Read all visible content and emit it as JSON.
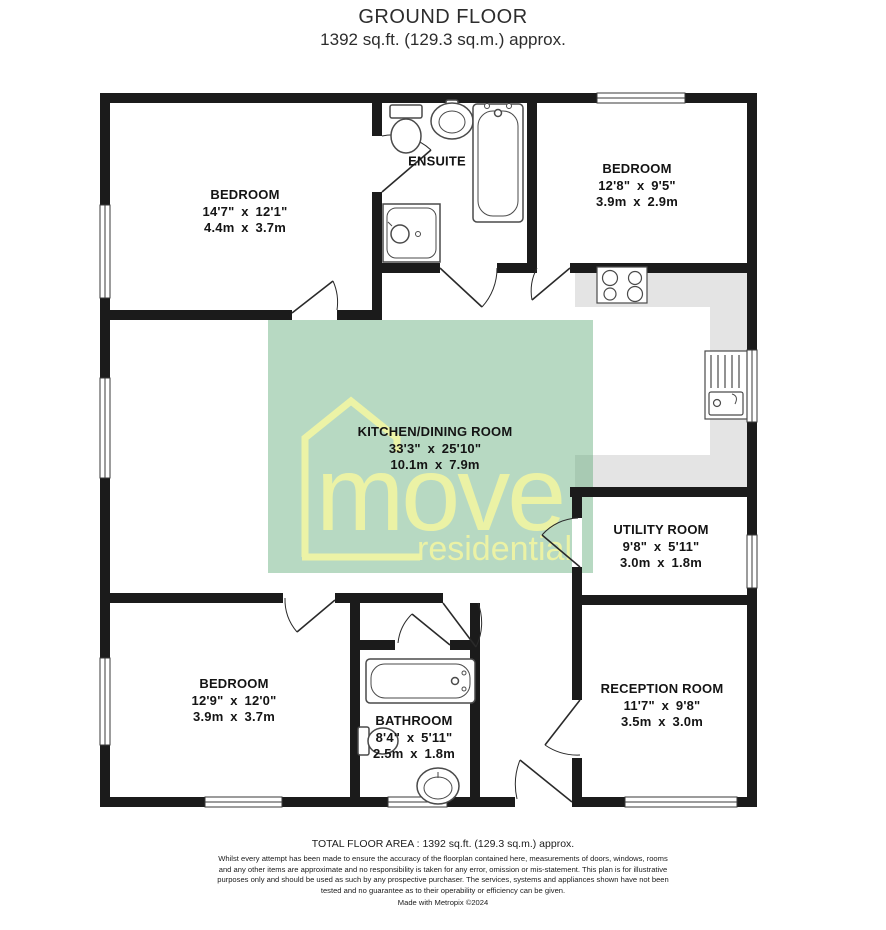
{
  "header": {
    "title": "GROUND FLOOR",
    "subtitle": "1392 sq.ft. (129.3 sq.m.) approx."
  },
  "rooms": {
    "bedroom_tl": {
      "name": "BEDROOM",
      "imperial": "14'7\" x 12'1\"",
      "metric": "4.4m x 3.7m"
    },
    "ensuite": {
      "name": "ENSUITE"
    },
    "bedroom_tr": {
      "name": "BEDROOM",
      "imperial": "12'8\" x 9'5\"",
      "metric": "3.9m x 2.9m"
    },
    "kitchen": {
      "name": "KITCHEN/DINING ROOM",
      "imperial": "33'3\" x 25'10\"",
      "metric": "10.1m x 7.9m"
    },
    "utility": {
      "name": "UTILITY ROOM",
      "imperial": "9'8\" x 5'11\"",
      "metric": "3.0m x 1.8m"
    },
    "bedroom_bl": {
      "name": "BEDROOM",
      "imperial": "12'9\" x 12'0\"",
      "metric": "3.9m x 3.7m"
    },
    "bathroom": {
      "name": "BATHROOM",
      "imperial": "8'4\" x 5'11\"",
      "metric": "2.5m x 1.8m"
    },
    "reception": {
      "name": "RECEPTION ROOM",
      "imperial": "11'7\" x 9'8\"",
      "metric": "3.5m x 3.0m"
    }
  },
  "watermark": {
    "brand": "move",
    "tagline": "residential"
  },
  "footer": {
    "total_area": "TOTAL FLOOR AREA : 1392 sq.ft. (129.3 sq.m.) approx.",
    "disclaimer": "Whilst every attempt has been made to ensure the accuracy of the floorplan contained here, measurements of doors, windows, rooms and any other items are approximate and no responsibility is taken for any error, omission or mis-statement. This plan is for illustrative purposes only and should be used as such by any prospective purchaser. The services, systems and appliances shown have not been tested and no guarantee as to their operability or efficiency can be given.",
    "credit": "Made with Metropix ©2024"
  },
  "colors": {
    "wall": "#1b1b1b",
    "counter": "#e4e4e4",
    "fixture_stroke": "#4a4a4a",
    "watermark_green": "#5faa78",
    "watermark_text": "#eef4a4"
  }
}
